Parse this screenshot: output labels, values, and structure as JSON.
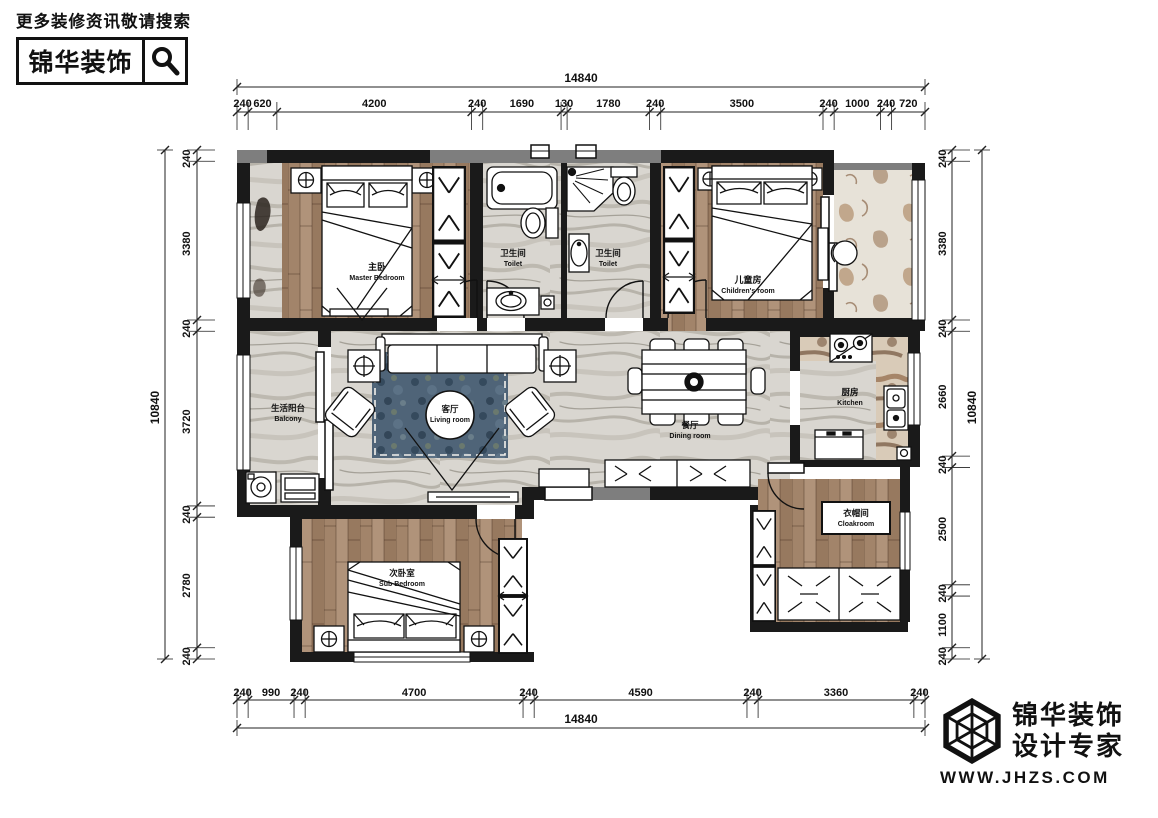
{
  "header": {
    "search_hint": "更多装修资讯敬请搜索",
    "brand": "锦华装饰"
  },
  "footer": {
    "brand_line1": "锦华装饰",
    "brand_line2": "设计专家",
    "url": "WWW.JHZS.COM"
  },
  "floorplan": {
    "rooms": [
      {
        "id": "master-bedroom",
        "cn": "主卧",
        "en": "Master Bedroom",
        "x": 377,
        "y": 272,
        "cs": 9,
        "es": 7
      },
      {
        "id": "toilet-1",
        "cn": "卫生间",
        "en": "Toilet",
        "x": 513,
        "y": 258,
        "cs": 8.5,
        "es": 7
      },
      {
        "id": "toilet-2",
        "cn": "卫生间",
        "en": "Toilet",
        "x": 608,
        "y": 258,
        "cs": 8.5,
        "es": 7
      },
      {
        "id": "children-room",
        "cn": "儿童房",
        "en": "Children's room",
        "x": 748,
        "y": 285,
        "cs": 9,
        "es": 7
      },
      {
        "id": "balcony",
        "cn": "生活阳台",
        "en": "Balcony",
        "x": 288,
        "y": 413,
        "cs": 8.5,
        "es": 7
      },
      {
        "id": "living-room",
        "cn": "客厅",
        "en": "Living room",
        "x": 450,
        "y": 414,
        "cs": 8.5,
        "es": 7
      },
      {
        "id": "dining-room",
        "cn": "餐厅",
        "en": "Dining room",
        "x": 690,
        "y": 430,
        "cs": 8.5,
        "es": 7
      },
      {
        "id": "kitchen",
        "cn": "厨房",
        "en": "Kitchen",
        "x": 850,
        "y": 397,
        "cs": 8.5,
        "es": 7
      },
      {
        "id": "cloakroom",
        "cn": "衣帽间",
        "en": "Cloakroom",
        "x": 856,
        "y": 518,
        "cs": 8.5,
        "es": 7
      },
      {
        "id": "sub-bedroom",
        "cn": "次卧室",
        "en": "Sub Bedroom",
        "x": 402,
        "y": 578,
        "cs": 8.5,
        "es": 7
      }
    ],
    "dimensions": {
      "top": {
        "total": "14840",
        "segments": [
          "240",
          "620",
          "4200",
          "240",
          "1690",
          "130",
          "1780",
          "240",
          "3500",
          "240",
          "1000",
          "240",
          "720"
        ]
      },
      "bottom": {
        "total": "14840",
        "segments": [
          "240",
          "990",
          "240",
          "4700",
          "240",
          "4590",
          "240",
          "3360",
          "240"
        ]
      },
      "left": {
        "total": "10840",
        "segments": [
          "240",
          "3380",
          "240",
          "3720",
          "240",
          "2780",
          "240"
        ]
      },
      "right": {
        "total": "10840",
        "segments": [
          "240",
          "3380",
          "240",
          "2660",
          "240",
          "2500",
          "240",
          "1100",
          "240"
        ]
      }
    },
    "colors": {
      "wall_black": "#1a1a1a",
      "wall_gray": "#7e7e7e",
      "wood": "#a2846a",
      "marble": "#d9d6d0",
      "rug_blue": "#4f6478",
      "counter_brown": "#c9ae92"
    }
  }
}
